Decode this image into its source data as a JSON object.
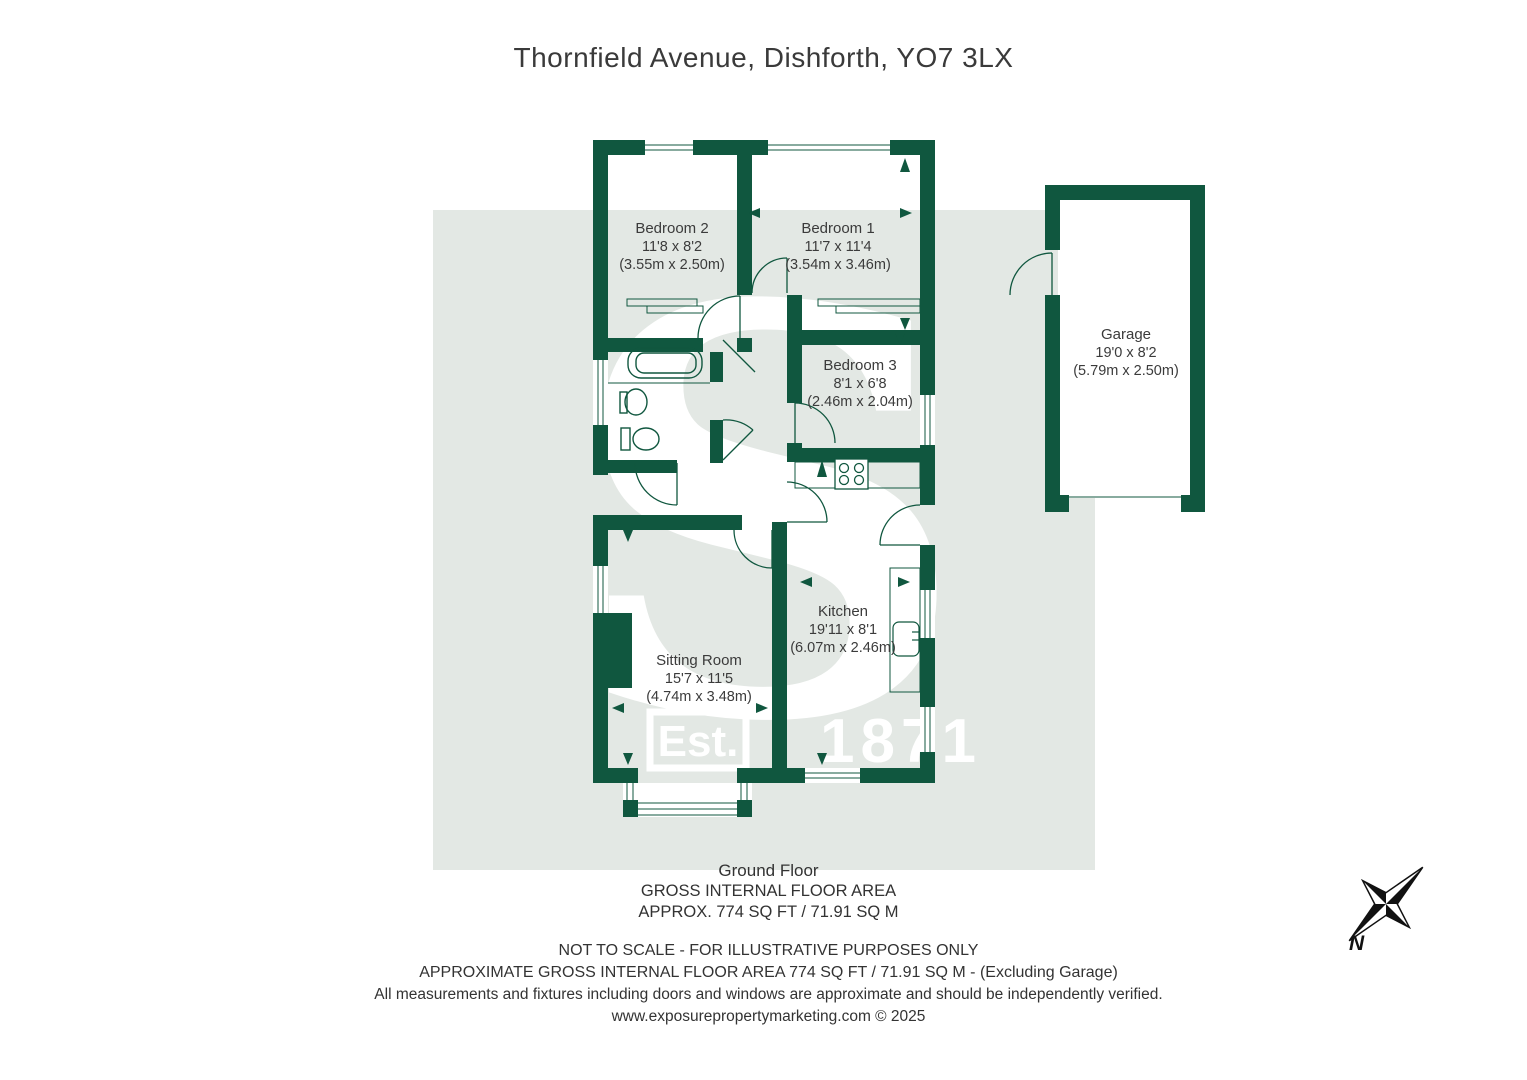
{
  "title": "Thornfield Avenue, Dishforth, YO7 3LX",
  "colors": {
    "wall_green": "#10573f",
    "background_band": "#e3e8e4",
    "text": "#3b3b3b",
    "watermark": "#ffffff",
    "compass": "#111111"
  },
  "plan": {
    "rooms": [
      {
        "name": "Bedroom 2",
        "imperial": "11'8 x 8'2",
        "metric": "(3.55m x 2.50m)"
      },
      {
        "name": "Bedroom 1",
        "imperial": "11'7 x 11'4",
        "metric": "(3.54m x 3.46m)"
      },
      {
        "name": "Bedroom 3",
        "imperial": "8'1 x 6'8",
        "metric": "(2.46m x 2.04m)"
      },
      {
        "name": "Garage",
        "imperial": "19'0 x 8'2",
        "metric": "(5.79m x 2.50m)"
      },
      {
        "name": "Sitting Room",
        "imperial": "15'7 x 11'5",
        "metric": "(4.74m x 3.48m)"
      },
      {
        "name": "Kitchen",
        "imperial": "19'11 x 8'1",
        "metric": "(6.07m x 2.46m)"
      }
    ],
    "watermark": {
      "est": "Est.",
      "year": "1871"
    },
    "compass_north_label": "N"
  },
  "footer": {
    "floor": "Ground Floor",
    "area_heading": "GROSS INTERNAL FLOOR AREA",
    "area_value": "APPROX. 774 SQ FT / 71.91 SQ M",
    "disclaimer1": "NOT TO SCALE - FOR ILLUSTRATIVE PURPOSES ONLY",
    "disclaimer2": "APPROXIMATE GROSS INTERNAL FLOOR AREA 774 SQ FT / 71.91 SQ M - (Excluding Garage)",
    "disclaimer3": "All measurements and fixtures including doors and windows are approximate and should be independently verified.",
    "website": "www.exposurepropertymarketing.com © 2025"
  }
}
